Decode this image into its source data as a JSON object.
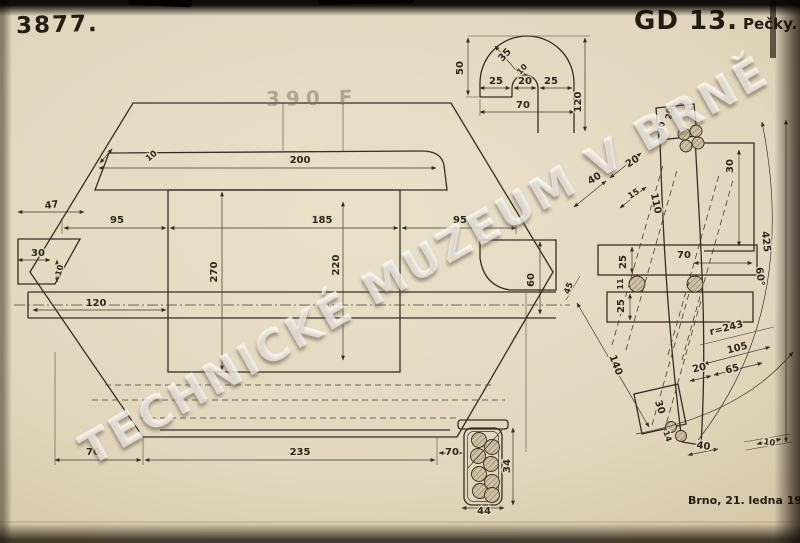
{
  "header": {
    "drawing_number": "3877.",
    "code": "GD 13.",
    "place": "Pečky.",
    "stamp": "390 F"
  },
  "footer": {
    "date": "Brno, 21. ledna 1920."
  },
  "watermark": "TECHNICKÉ MUZEUM V BRNĚ",
  "colors": {
    "paper": "#e5dbc4",
    "ink": "#2e2820",
    "background": "#0d0a06",
    "watermark": "rgba(255,255,255,0.62)"
  },
  "labels": {
    "main": {
      "d200": "200",
      "c10": "10",
      "d47": "47",
      "g95l": "95",
      "d185": "185",
      "g95r": "95",
      "t30": "30",
      "t10": "10",
      "d270": "270",
      "d220": "220",
      "t60": "60",
      "d120": "120",
      "b70l": "70",
      "b235": "235",
      "b70r": "70"
    },
    "hook": {
      "h50": "50",
      "r35": "35",
      "r10": "10",
      "l25": "25",
      "s20": "20",
      "r25": "25",
      "w70": "70",
      "h120": "120"
    },
    "section": {
      "h34": "34",
      "w44": "44"
    },
    "link": {
      "top20": "20",
      "top30": "30",
      "d40": "40",
      "d20": "20",
      "d15": "15",
      "len110": "110",
      "sq30": "30",
      "p70": "70",
      "p25a": "25",
      "g11": "11",
      "p25b": "25",
      "l45": "45",
      "d140": "140",
      "bp30": "30",
      "bp14": "14",
      "b40": "40",
      "b10": "10",
      "e20": "20",
      "e65": "65",
      "e105": "105",
      "radius": "r=243",
      "arc425": "425",
      "ang60": "60°"
    }
  }
}
